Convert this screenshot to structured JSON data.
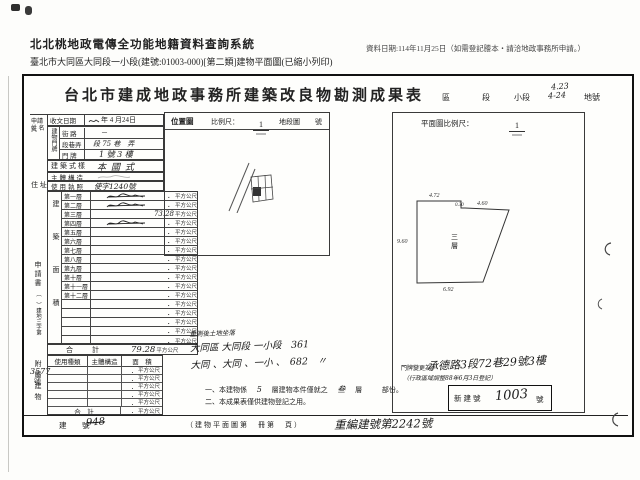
{
  "page_header": {
    "system_title": "北北桃地政電傳全功能地籍資料查詢系統",
    "document_line": "臺北市大同區大同段一小段(建號:01003-000)[第二類]建物平面圖(已縮小列印)",
    "date_info": "資料日期:114年11月25日（如需登記謄本‧請洽地政事務所申請。）"
  },
  "form": {
    "title": "台北市建成地政事務所建築改良物勘測成果表",
    "locality": {
      "district_label": "區",
      "section_label": "段",
      "subsection_label": "小段",
      "lot_label": "地號",
      "handwritten_upper": "4.23",
      "handwritten_lower": "4-24"
    },
    "applicant": {
      "name_label_1": "申請人",
      "name_label_2": "姓 名",
      "receive_date_label": "收文日期",
      "receive_date_value": "年 4 月24日",
      "address_label": "住 址"
    },
    "building_address": {
      "group_label": "建物門牌",
      "street_label": "街 路",
      "street_value": "－",
      "lane_label": "段巷弄",
      "lane_value": "段 75 巷　弄",
      "number_label": "門 牌",
      "number_value": "1 號 3 樓"
    },
    "style_label": "建築式樣",
    "style_value": "本國式",
    "structure_label": "主體構造",
    "license_label": "使用執照",
    "license_value": "使字1240號",
    "floor_area": {
      "group_label": "建築面積",
      "unit": "平方公尺",
      "rows": [
        {
          "label": "第一層",
          "value": "．"
        },
        {
          "label": "第二層",
          "value": "．"
        },
        {
          "label": "第三層",
          "value": "73.28"
        },
        {
          "label": "第四層",
          "value": "．"
        },
        {
          "label": "第五層",
          "value": "．"
        },
        {
          "label": "第六層",
          "value": "．"
        },
        {
          "label": "第七層",
          "value": "．"
        },
        {
          "label": "第八層",
          "value": "．"
        },
        {
          "label": "第九層",
          "value": "．"
        },
        {
          "label": "第十層",
          "value": "．"
        },
        {
          "label": "第十一層",
          "value": "．"
        },
        {
          "label": "第十二層",
          "value": "．"
        },
        {
          "label": "",
          "value": "．"
        },
        {
          "label": "",
          "value": "．"
        },
        {
          "label": "",
          "value": "．"
        },
        {
          "label": "",
          "value": "．"
        },
        {
          "label": "",
          "value": "．"
        }
      ],
      "total_label": "合　計",
      "total_value": "79.28"
    },
    "application_doc": {
      "top": "申請書",
      "mid": "（　）建地三字第",
      "number": "3577",
      "suffix": "號"
    },
    "annex": {
      "group_label": "附屬建物",
      "headers": [
        "使用種類",
        "主體構造",
        "面　積"
      ],
      "row_value": "．",
      "unit": "平方公尺",
      "total_label": "合　計"
    },
    "location_map": {
      "title": "位置圖",
      "scale_label": "比例尺：",
      "scale_numerator": "1",
      "sheet_label": "地段圖",
      "number_label": "號"
    },
    "floor_plan": {
      "header": "平面圖比例尺：",
      "scale_numerator": "1",
      "room_char1": "三",
      "room_char2": "層",
      "dim_top": "4.72",
      "dim_notch": "0.30",
      "dim_diag": "4.60",
      "dim_left": "9.60",
      "dim_bottom": "6.92"
    },
    "resurvey": {
      "line0": "重測後土地坐落",
      "line1": "大同區 大同段 一小段　361",
      "line2": "大同 、大同 、一小 、　682　〃"
    },
    "notes": {
      "n1a": "一、本建物係",
      "n1b": "5",
      "n1c": "層建物本件僅就之",
      "n1d": "叁",
      "n1e": "層",
      "n1f": "部份。",
      "n2": "二、本成果表僅供建物登記之用。"
    },
    "address_change": {
      "label": "門牌變更為:",
      "value": "承德路3段72巷29號3樓",
      "note": "（行政區域調整88年6月3日登記）"
    },
    "new_building_no": {
      "label": "新建號",
      "value": "1003",
      "suffix": "號"
    },
    "bottom": {
      "building_no_label": "建　號",
      "building_no_value": "948",
      "plan_book_label": "（建物平面圖第　冊第　頁）",
      "renumber_text": "重編建號第2242號"
    }
  }
}
